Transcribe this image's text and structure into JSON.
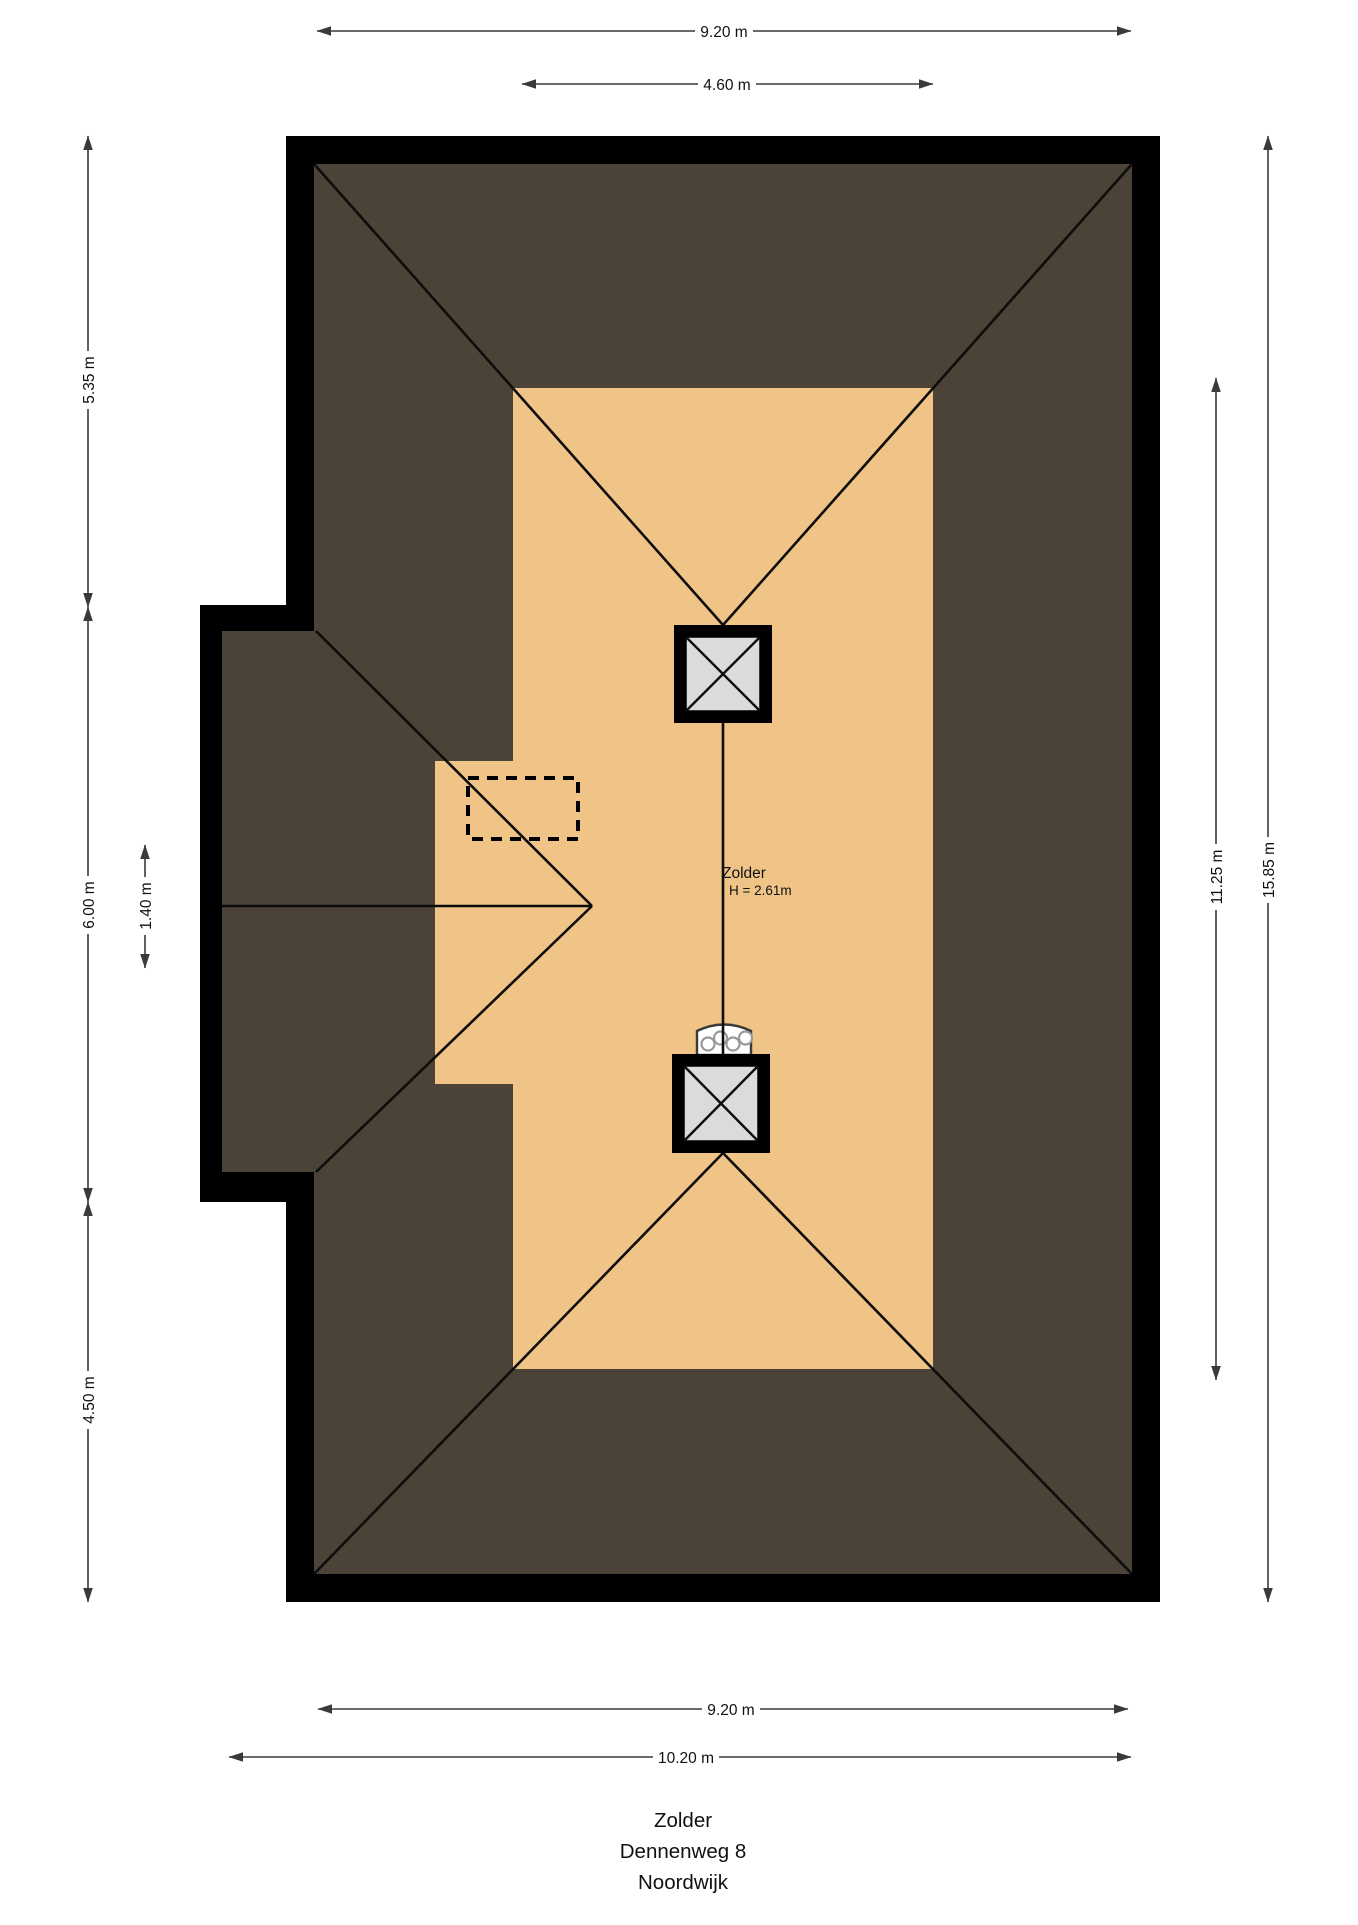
{
  "room": {
    "name": "Zolder",
    "height": "H = 2.61m"
  },
  "dimensions": {
    "top_outer": "9.20 m",
    "top_inner": "4.60 m",
    "bottom_inner": "9.20 m",
    "bottom_outer": "10.20 m",
    "left_top": "5.35 m",
    "left_middle": "6.00 m",
    "left_bottom": "4.50 m",
    "left_inner": "1.40 m",
    "right_inner": "11.25 m",
    "right_outer": "15.85 m"
  },
  "title_block": {
    "lines": [
      "Zolder",
      "Dennenweg 8",
      "Noordwijk"
    ]
  },
  "colors": {
    "wall": "#000000",
    "roof": "#4B4337",
    "floor": "#F0C386",
    "skylight_glass": "#DBDBDB",
    "roof_line": "#0d0d0d",
    "dim_line": "#3a3a3a",
    "chimney_detail": "#999999",
    "text": "#111111",
    "background": "#FFFFFF"
  }
}
